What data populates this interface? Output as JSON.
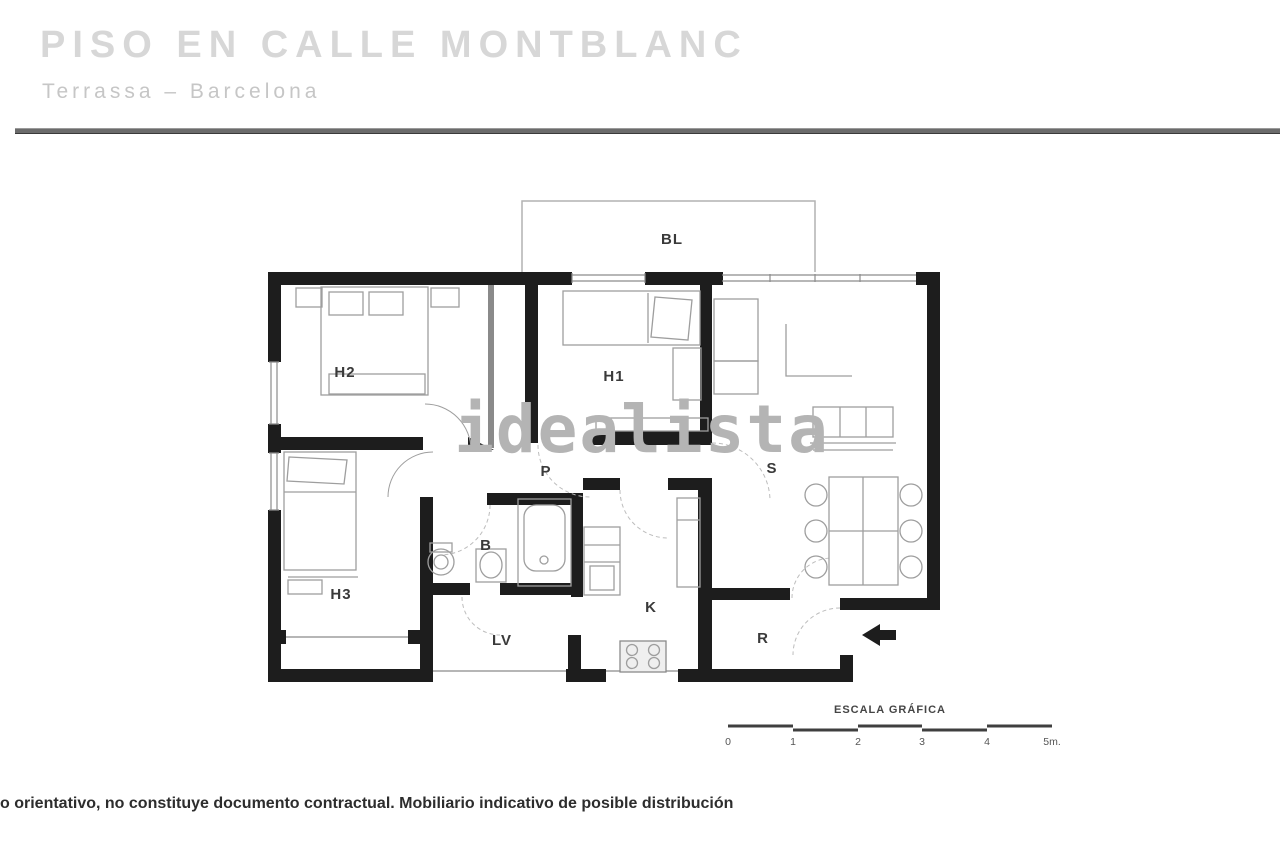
{
  "header": {
    "title": "PISO EN CALLE MONTBLANC",
    "subtitle": "Terrassa  –  Barcelona"
  },
  "watermark": "idealista",
  "floorplan": {
    "rooms": {
      "bl": "BL",
      "h2": "H2",
      "h1": "H1",
      "s": "S",
      "p": "P",
      "h3": "H3",
      "b": "B",
      "k": "K",
      "lv": "LV",
      "r": "R"
    },
    "entrance_arrow": "left-arrow"
  },
  "scale_bar": {
    "title": "ESCALA GRÁFICA",
    "ticks": [
      "0",
      "1",
      "2",
      "3",
      "4",
      "5m."
    ]
  },
  "footer": {
    "disclaimer": "o orientativo, no constituye documento contractual. Mobiliario indicativo de posible distribución"
  },
  "colors": {
    "wall": "#1d1d1d",
    "furniture": "#9e9e9e",
    "watermark": "#b4b4b4",
    "header_title": "#d7d7d7",
    "header_subtitle": "#c6c6c6",
    "divider": "#6b6b6b",
    "label": "#3a3a3a"
  }
}
